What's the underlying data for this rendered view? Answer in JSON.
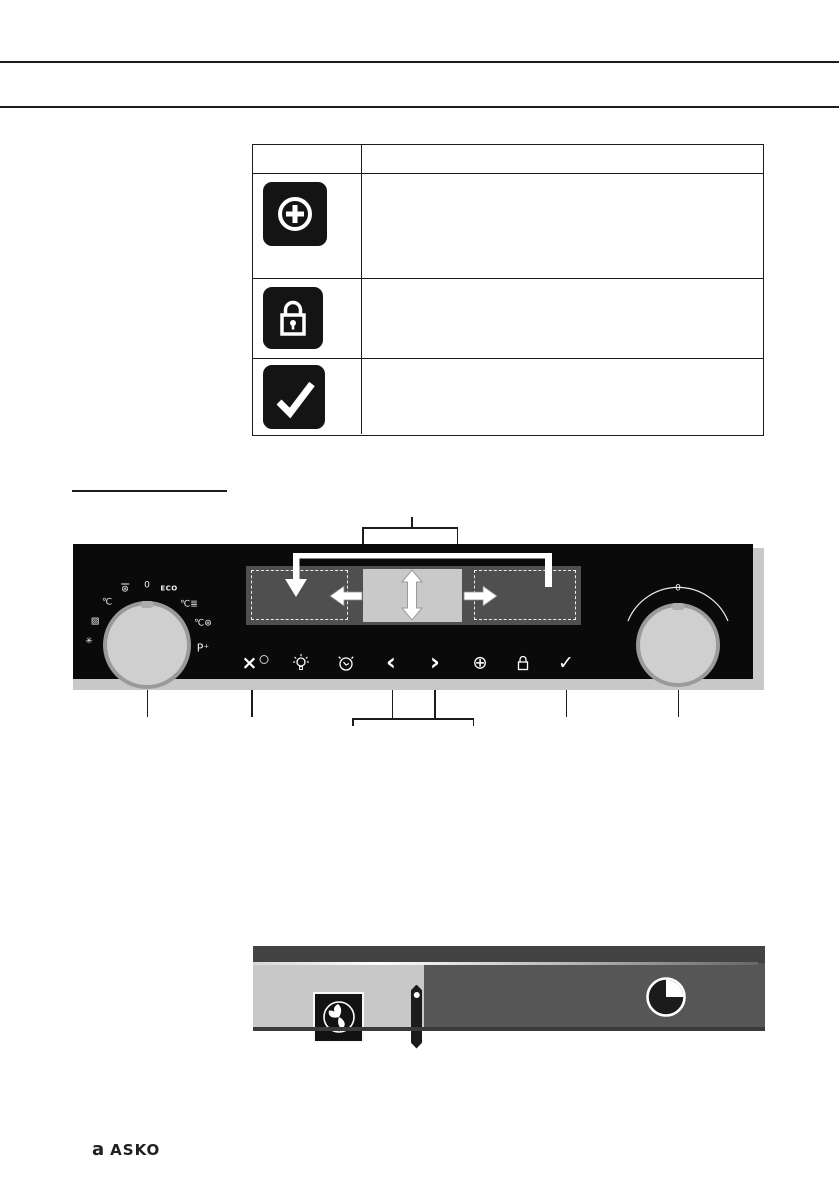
{
  "header": {
    "note": "two horizontal rules, no text"
  },
  "table": {
    "header_row": {
      "col1": "",
      "col2": ""
    },
    "rows": [
      {
        "icon": "plus-circle-key-icon",
        "description": ""
      },
      {
        "icon": "lock-key-icon",
        "description": ""
      },
      {
        "icon": "confirm-key-icon",
        "description": ""
      }
    ]
  },
  "panel": {
    "left_knob_symbols": [
      {
        "id": "grill-fan",
        "glyph": "⊛"
      },
      {
        "id": "off",
        "glyph": "0"
      },
      {
        "id": "eco",
        "glyph": "ECO"
      },
      {
        "id": "hot-air-levels",
        "glyph": "℃≣"
      },
      {
        "id": "fan-temp",
        "glyph": "℃⊛"
      },
      {
        "id": "program-plus",
        "glyph": "P⁺"
      },
      {
        "id": "temp",
        "glyph": "℃"
      },
      {
        "id": "grill-pan",
        "glyph": "▨"
      },
      {
        "id": "defrost",
        "glyph": "✳"
      }
    ],
    "right_knob": {
      "zero_label": "0"
    },
    "buttons": [
      {
        "id": "power",
        "glyph": "×"
      },
      {
        "id": "light",
        "glyph": ""
      },
      {
        "id": "minute-minder",
        "glyph": ""
      },
      {
        "id": "previous",
        "glyph": "‹"
      },
      {
        "id": "next",
        "glyph": "›"
      },
      {
        "id": "extra",
        "glyph": "⊕"
      },
      {
        "id": "lock",
        "glyph": ""
      },
      {
        "id": "confirm",
        "glyph": "✓"
      }
    ]
  },
  "status_bar": {
    "left_icon": "fan-icon",
    "right_icon": "timer-quarter-icon"
  },
  "footer": {
    "logo_mark": "a",
    "wordmark": "ASKO"
  },
  "colors": {
    "panel_bg": "#0a0a0a",
    "panel_trim": "#c8c8c8",
    "display_bg": "#4f4f4f",
    "display_center": "#c9c9c9",
    "status_left": "#c8c8c8",
    "status_right": "#565656",
    "rule": "#1c1c1c"
  }
}
